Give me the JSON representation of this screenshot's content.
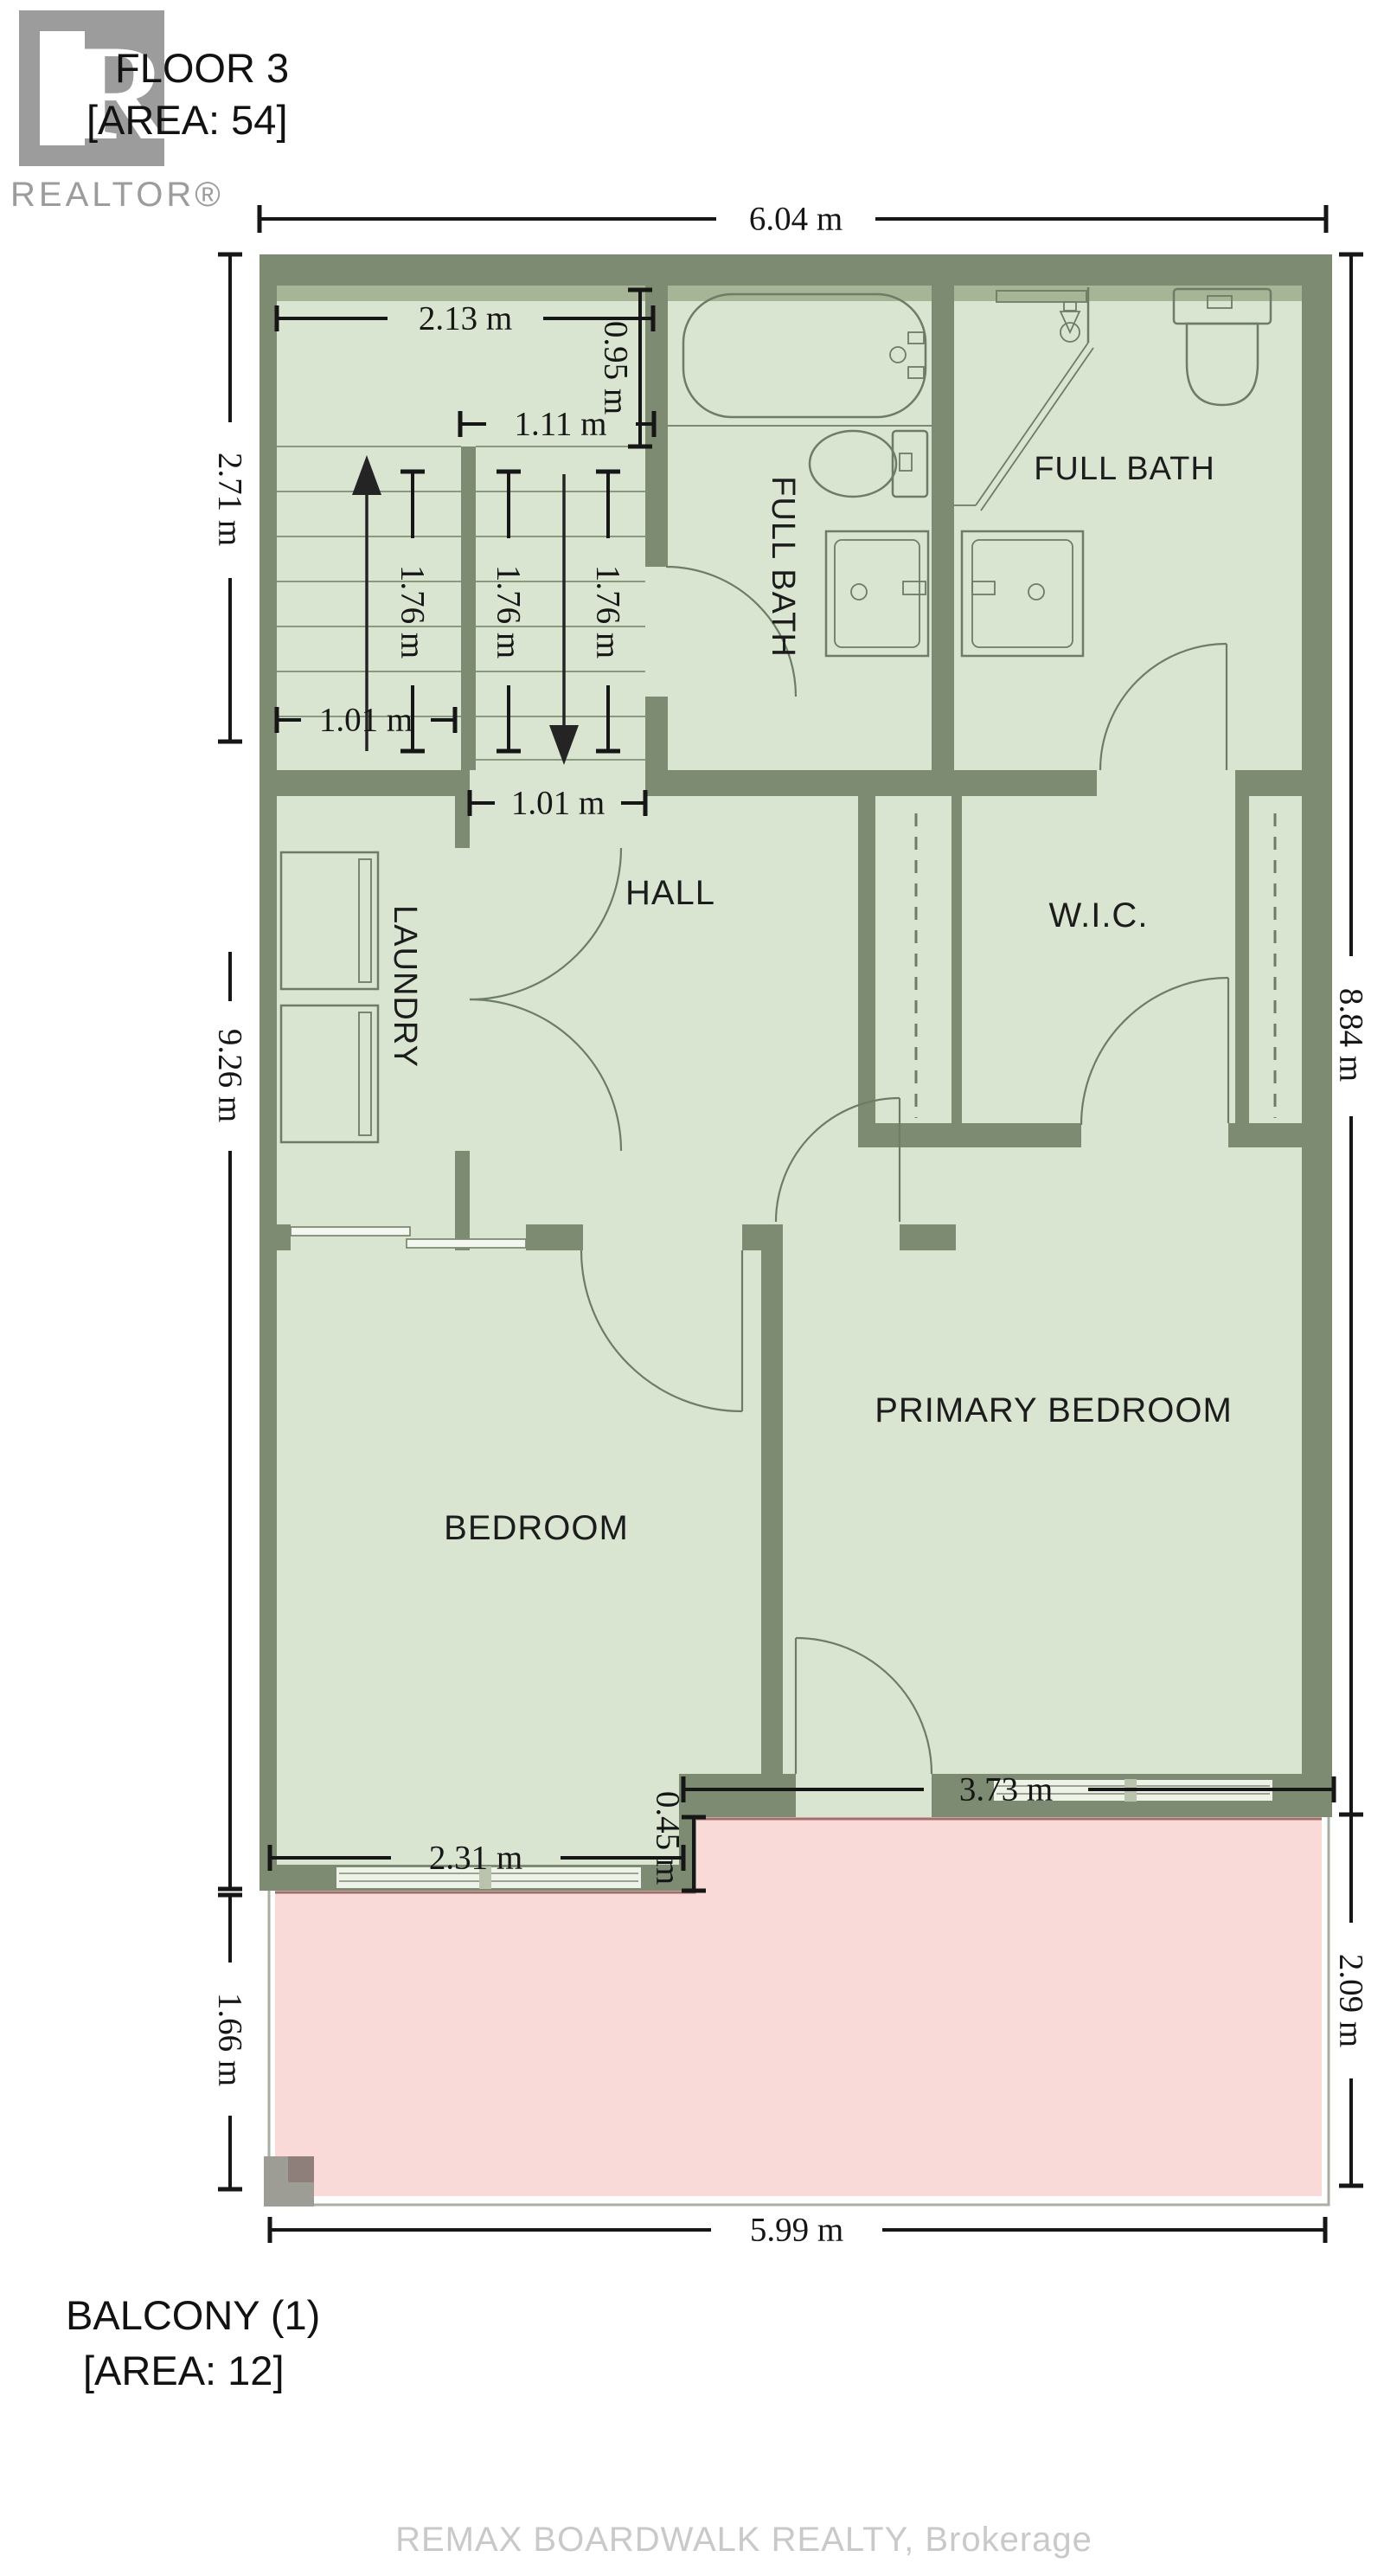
{
  "page": {
    "title_line1": "FLOOR 3",
    "title_line2": "[AREA: 54]"
  },
  "logo": {
    "glyph": "R",
    "wordmark": "REALTOR®"
  },
  "rooms": {
    "full_bath_1": "FULL BATH",
    "full_bath_2": "FULL BATH",
    "laundry": "LAUNDRY",
    "hall": "HALL",
    "wic": "W.I.C.",
    "primary_bedroom": "PRIMARY BEDROOM",
    "bedroom": "BEDROOM"
  },
  "dimensions": {
    "total_width": "6.04 m",
    "stair_landing_width": "2.13 m",
    "stair_landing_depth": "0.95 m",
    "stair_upper_run_width": "1.11 m",
    "stair_run_length_left": "1.76 m",
    "stair_run_length_mid": "1.76 m",
    "stair_run_length_right": "1.76 m",
    "stair_lower_width": "1.01 m",
    "hall_opening_width": "1.01 m",
    "left_height_upper": "2.71 m",
    "left_height_total": "9.26 m",
    "right_height": "8.84 m",
    "primary_opening_width": "3.73 m",
    "step_depth": "0.45 m",
    "bedroom_window_width": "2.31 m",
    "balcony_depth_right": "2.09 m",
    "balcony_depth_left": "1.66 m",
    "balcony_width": "5.99 m"
  },
  "balcony": {
    "label": "BALCONY (1)",
    "area_label": "[AREA: 12]"
  },
  "footer": {
    "watermark": "REMAX BOARDWALK REALTY, Brokerage"
  },
  "theme": {
    "wall": "#7e8b73",
    "floor": "#d9e5d1",
    "wall_shadow": "#a6b596",
    "balcony_fill": "#f9dad8",
    "balcony_edge": "#a06e6b",
    "fixture_stroke": "#6d7c64",
    "dim_color": "#161616",
    "logo_gray": "#9c9c9c",
    "watermark_gray": "#c9c9c9",
    "window_fill": "#eef2e9",
    "railing": "#a9aea2",
    "post": "#9e9d95"
  }
}
